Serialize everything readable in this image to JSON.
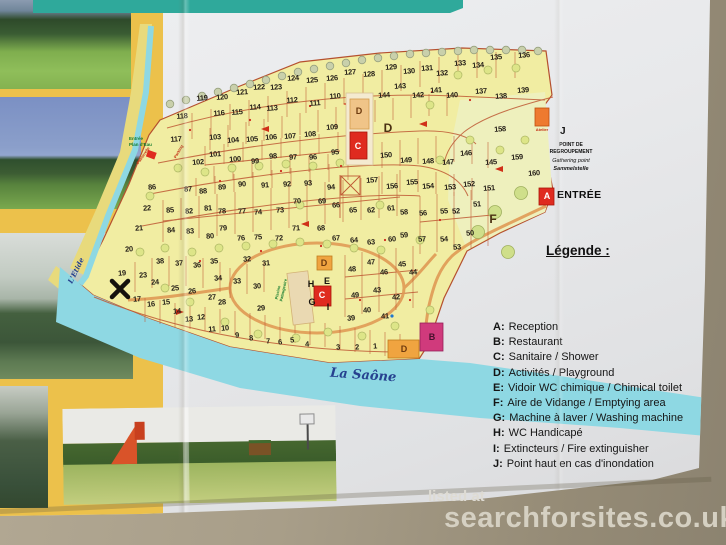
{
  "brochure": {
    "watermark": {
      "prefix": "listed at",
      "site": "searchforsites.co.uk"
    },
    "legend": {
      "title": "Légende :",
      "items": [
        {
          "key": "A:",
          "label": "Reception"
        },
        {
          "key": "B:",
          "label": "Restaurant"
        },
        {
          "key": "C:",
          "label": "Sanitaire / Shower"
        },
        {
          "key": "D:",
          "label": "Activités / Playground"
        },
        {
          "key": "E:",
          "label": "Vidoir WC chimique / Chimical toilet"
        },
        {
          "key": "F:",
          "label": "Aire de Vidange / Emptying area"
        },
        {
          "key": "G:",
          "label": "Machine à laver / Washing machine"
        },
        {
          "key": "H:",
          "label": "WC Handicapé"
        },
        {
          "key": "I:",
          "label": "Extincteurs / Fire extinguisher"
        },
        {
          "key": "J:",
          "label": "Point haut en cas d'inondation"
        }
      ]
    },
    "map": {
      "river_label": "La Saône",
      "stream_label": "L'Etide",
      "entrance_label": "ENTRÉE",
      "plan_eau_line1": "Entrée",
      "plan_eau_line2": "Plan d'Eau",
      "passerelle_label": "Passerelle",
      "parking_label": "Parking",
      "pool_label": "Piscine Pataugeoire",
      "atelier_label": "Atelier",
      "gathering": {
        "letter": "J",
        "line1": "POINT DE",
        "line2": "REGROUPEMENT",
        "line3": "Gathering point",
        "line4": "Sammelstelle"
      },
      "facilities": [
        {
          "letter": "D",
          "x": 359,
          "y": 111,
          "cls": "on-orange"
        },
        {
          "letter": "C",
          "x": 358,
          "y": 146,
          "cls": "on-red"
        },
        {
          "letter": "D",
          "x": 388,
          "y": 128,
          "cls": "area"
        },
        {
          "letter": "D",
          "x": 324,
          "y": 263,
          "cls": "on-orange"
        },
        {
          "letter": "H",
          "x": 311,
          "y": 284,
          "cls": "plain"
        },
        {
          "letter": "E",
          "x": 327,
          "y": 281,
          "cls": "plain"
        },
        {
          "letter": "C",
          "x": 322,
          "y": 295,
          "cls": "on-red"
        },
        {
          "letter": "G",
          "x": 312,
          "y": 302,
          "cls": "plain"
        },
        {
          "letter": "I",
          "x": 328,
          "y": 307,
          "cls": "plain"
        },
        {
          "letter": "B",
          "x": 432,
          "y": 337,
          "cls": "on-pink"
        },
        {
          "letter": "D",
          "x": 404,
          "y": 349,
          "cls": "on-orange"
        },
        {
          "letter": "F",
          "x": 493,
          "y": 219,
          "cls": "area"
        },
        {
          "letter": "A",
          "x": 547,
          "y": 196,
          "cls": "on-red"
        }
      ],
      "plots": [
        {
          "n": "1",
          "x": 375,
          "y": 346
        },
        {
          "n": "2",
          "x": 357,
          "y": 347
        },
        {
          "n": "3",
          "x": 338,
          "y": 347
        },
        {
          "n": "4",
          "x": 307,
          "y": 344
        },
        {
          "n": "5",
          "x": 292,
          "y": 340
        },
        {
          "n": "6",
          "x": 280,
          "y": 342
        },
        {
          "n": "7",
          "x": 268,
          "y": 341
        },
        {
          "n": "8",
          "x": 251,
          "y": 338
        },
        {
          "n": "9",
          "x": 237,
          "y": 335
        },
        {
          "n": "10",
          "x": 225,
          "y": 328
        },
        {
          "n": "11",
          "x": 212,
          "y": 329
        },
        {
          "n": "12",
          "x": 201,
          "y": 317
        },
        {
          "n": "13",
          "x": 189,
          "y": 319
        },
        {
          "n": "14",
          "x": 177,
          "y": 311
        },
        {
          "n": "15",
          "x": 166,
          "y": 302
        },
        {
          "n": "16",
          "x": 151,
          "y": 304
        },
        {
          "n": "17",
          "x": 137,
          "y": 299
        },
        {
          "n": "19",
          "x": 122,
          "y": 273
        },
        {
          "n": "20",
          "x": 129,
          "y": 249
        },
        {
          "n": "21",
          "x": 139,
          "y": 228
        },
        {
          "n": "22",
          "x": 147,
          "y": 208
        },
        {
          "n": "23",
          "x": 143,
          "y": 275
        },
        {
          "n": "24",
          "x": 155,
          "y": 282
        },
        {
          "n": "25",
          "x": 175,
          "y": 288
        },
        {
          "n": "26",
          "x": 192,
          "y": 291
        },
        {
          "n": "27",
          "x": 212,
          "y": 297
        },
        {
          "n": "28",
          "x": 222,
          "y": 302
        },
        {
          "n": "29",
          "x": 261,
          "y": 308
        },
        {
          "n": "30",
          "x": 257,
          "y": 286
        },
        {
          "n": "31",
          "x": 266,
          "y": 263
        },
        {
          "n": "32",
          "x": 247,
          "y": 259
        },
        {
          "n": "33",
          "x": 237,
          "y": 281
        },
        {
          "n": "34",
          "x": 218,
          "y": 278
        },
        {
          "n": "35",
          "x": 214,
          "y": 261
        },
        {
          "n": "36",
          "x": 197,
          "y": 265
        },
        {
          "n": "37",
          "x": 179,
          "y": 263
        },
        {
          "n": "38",
          "x": 160,
          "y": 261
        },
        {
          "n": "39",
          "x": 351,
          "y": 318
        },
        {
          "n": "40",
          "x": 367,
          "y": 310
        },
        {
          "n": "41",
          "x": 385,
          "y": 316
        },
        {
          "n": "42",
          "x": 396,
          "y": 297
        },
        {
          "n": "43",
          "x": 377,
          "y": 290
        },
        {
          "n": "44",
          "x": 413,
          "y": 272
        },
        {
          "n": "45",
          "x": 402,
          "y": 264
        },
        {
          "n": "46",
          "x": 384,
          "y": 272
        },
        {
          "n": "47",
          "x": 371,
          "y": 262
        },
        {
          "n": "48",
          "x": 352,
          "y": 269
        },
        {
          "n": "49",
          "x": 355,
          "y": 295
        },
        {
          "n": "50",
          "x": 470,
          "y": 233
        },
        {
          "n": "51",
          "x": 477,
          "y": 204
        },
        {
          "n": "52",
          "x": 456,
          "y": 211
        },
        {
          "n": "53",
          "x": 457,
          "y": 247
        },
        {
          "n": "54",
          "x": 444,
          "y": 239
        },
        {
          "n": "55",
          "x": 444,
          "y": 211
        },
        {
          "n": "56",
          "x": 423,
          "y": 213
        },
        {
          "n": "57",
          "x": 422,
          "y": 239
        },
        {
          "n": "58",
          "x": 404,
          "y": 212
        },
        {
          "n": "59",
          "x": 404,
          "y": 235
        },
        {
          "n": "60",
          "x": 392,
          "y": 239
        },
        {
          "n": "61",
          "x": 391,
          "y": 208
        },
        {
          "n": "62",
          "x": 371,
          "y": 210
        },
        {
          "n": "63",
          "x": 371,
          "y": 242
        },
        {
          "n": "64",
          "x": 354,
          "y": 240
        },
        {
          "n": "65",
          "x": 353,
          "y": 210
        },
        {
          "n": "66",
          "x": 336,
          "y": 205
        },
        {
          "n": "67",
          "x": 336,
          "y": 238
        },
        {
          "n": "68",
          "x": 321,
          "y": 228
        },
        {
          "n": "69",
          "x": 322,
          "y": 201
        },
        {
          "n": "70",
          "x": 297,
          "y": 201
        },
        {
          "n": "71",
          "x": 296,
          "y": 228
        },
        {
          "n": "72",
          "x": 279,
          "y": 238
        },
        {
          "n": "73",
          "x": 280,
          "y": 210
        },
        {
          "n": "74",
          "x": 258,
          "y": 212
        },
        {
          "n": "75",
          "x": 258,
          "y": 237
        },
        {
          "n": "76",
          "x": 241,
          "y": 238
        },
        {
          "n": "77",
          "x": 242,
          "y": 211
        },
        {
          "n": "78",
          "x": 222,
          "y": 211
        },
        {
          "n": "79",
          "x": 223,
          "y": 228
        },
        {
          "n": "80",
          "x": 210,
          "y": 236
        },
        {
          "n": "81",
          "x": 208,
          "y": 208
        },
        {
          "n": "82",
          "x": 189,
          "y": 211
        },
        {
          "n": "83",
          "x": 190,
          "y": 231
        },
        {
          "n": "84",
          "x": 171,
          "y": 230
        },
        {
          "n": "85",
          "x": 170,
          "y": 210
        },
        {
          "n": "86",
          "x": 152,
          "y": 187
        },
        {
          "n": "87",
          "x": 188,
          "y": 189
        },
        {
          "n": "88",
          "x": 203,
          "y": 191
        },
        {
          "n": "89",
          "x": 222,
          "y": 187
        },
        {
          "n": "90",
          "x": 242,
          "y": 184
        },
        {
          "n": "91",
          "x": 265,
          "y": 185
        },
        {
          "n": "92",
          "x": 287,
          "y": 184
        },
        {
          "n": "93",
          "x": 308,
          "y": 183
        },
        {
          "n": "94",
          "x": 331,
          "y": 187
        },
        {
          "n": "95",
          "x": 335,
          "y": 152
        },
        {
          "n": "96",
          "x": 313,
          "y": 157
        },
        {
          "n": "97",
          "x": 293,
          "y": 157
        },
        {
          "n": "98",
          "x": 273,
          "y": 156
        },
        {
          "n": "99",
          "x": 255,
          "y": 161
        },
        {
          "n": "100",
          "x": 235,
          "y": 159
        },
        {
          "n": "101",
          "x": 215,
          "y": 154
        },
        {
          "n": "102",
          "x": 198,
          "y": 162
        },
        {
          "n": "103",
          "x": 215,
          "y": 137
        },
        {
          "n": "104",
          "x": 233,
          "y": 140
        },
        {
          "n": "105",
          "x": 252,
          "y": 139
        },
        {
          "n": "106",
          "x": 271,
          "y": 137
        },
        {
          "n": "107",
          "x": 290,
          "y": 136
        },
        {
          "n": "108",
          "x": 310,
          "y": 134
        },
        {
          "n": "109",
          "x": 332,
          "y": 127
        },
        {
          "n": "110",
          "x": 335,
          "y": 96
        },
        {
          "n": "111",
          "x": 315,
          "y": 103
        },
        {
          "n": "112",
          "x": 292,
          "y": 100
        },
        {
          "n": "113",
          "x": 272,
          "y": 108
        },
        {
          "n": "114",
          "x": 255,
          "y": 107
        },
        {
          "n": "115",
          "x": 237,
          "y": 112
        },
        {
          "n": "116",
          "x": 219,
          "y": 113
        },
        {
          "n": "117",
          "x": 176,
          "y": 139
        },
        {
          "n": "118",
          "x": 182,
          "y": 116
        },
        {
          "n": "119",
          "x": 202,
          "y": 98
        },
        {
          "n": "120",
          "x": 222,
          "y": 97
        },
        {
          "n": "121",
          "x": 242,
          "y": 92
        },
        {
          "n": "122",
          "x": 259,
          "y": 87
        },
        {
          "n": "123",
          "x": 276,
          "y": 87
        },
        {
          "n": "124",
          "x": 293,
          "y": 78
        },
        {
          "n": "125",
          "x": 312,
          "y": 80
        },
        {
          "n": "126",
          "x": 332,
          "y": 78
        },
        {
          "n": "127",
          "x": 350,
          "y": 72
        },
        {
          "n": "128",
          "x": 369,
          "y": 74
        },
        {
          "n": "129",
          "x": 391,
          "y": 67
        },
        {
          "n": "130",
          "x": 409,
          "y": 71
        },
        {
          "n": "131",
          "x": 427,
          "y": 68
        },
        {
          "n": "132",
          "x": 442,
          "y": 73
        },
        {
          "n": "133",
          "x": 460,
          "y": 63
        },
        {
          "n": "134",
          "x": 478,
          "y": 65
        },
        {
          "n": "135",
          "x": 496,
          "y": 57
        },
        {
          "n": "136",
          "x": 524,
          "y": 55
        },
        {
          "n": "137",
          "x": 481,
          "y": 91
        },
        {
          "n": "138",
          "x": 501,
          "y": 96
        },
        {
          "n": "139",
          "x": 523,
          "y": 90
        },
        {
          "n": "140",
          "x": 452,
          "y": 95
        },
        {
          "n": "141",
          "x": 436,
          "y": 90
        },
        {
          "n": "142",
          "x": 418,
          "y": 95
        },
        {
          "n": "143",
          "x": 400,
          "y": 86
        },
        {
          "n": "144",
          "x": 384,
          "y": 95
        },
        {
          "n": "145",
          "x": 491,
          "y": 162
        },
        {
          "n": "146",
          "x": 466,
          "y": 153
        },
        {
          "n": "147",
          "x": 448,
          "y": 162
        },
        {
          "n": "148",
          "x": 428,
          "y": 161
        },
        {
          "n": "149",
          "x": 406,
          "y": 160
        },
        {
          "n": "150",
          "x": 386,
          "y": 155
        },
        {
          "n": "151",
          "x": 489,
          "y": 188
        },
        {
          "n": "152",
          "x": 469,
          "y": 184
        },
        {
          "n": "153",
          "x": 450,
          "y": 187
        },
        {
          "n": "154",
          "x": 428,
          "y": 186
        },
        {
          "n": "155",
          "x": 412,
          "y": 182
        },
        {
          "n": "156",
          "x": 392,
          "y": 186
        },
        {
          "n": "157",
          "x": 372,
          "y": 180
        },
        {
          "n": "158",
          "x": 500,
          "y": 129
        },
        {
          "n": "159",
          "x": 517,
          "y": 157
        },
        {
          "n": "160",
          "x": 534,
          "y": 173
        }
      ]
    }
  }
}
